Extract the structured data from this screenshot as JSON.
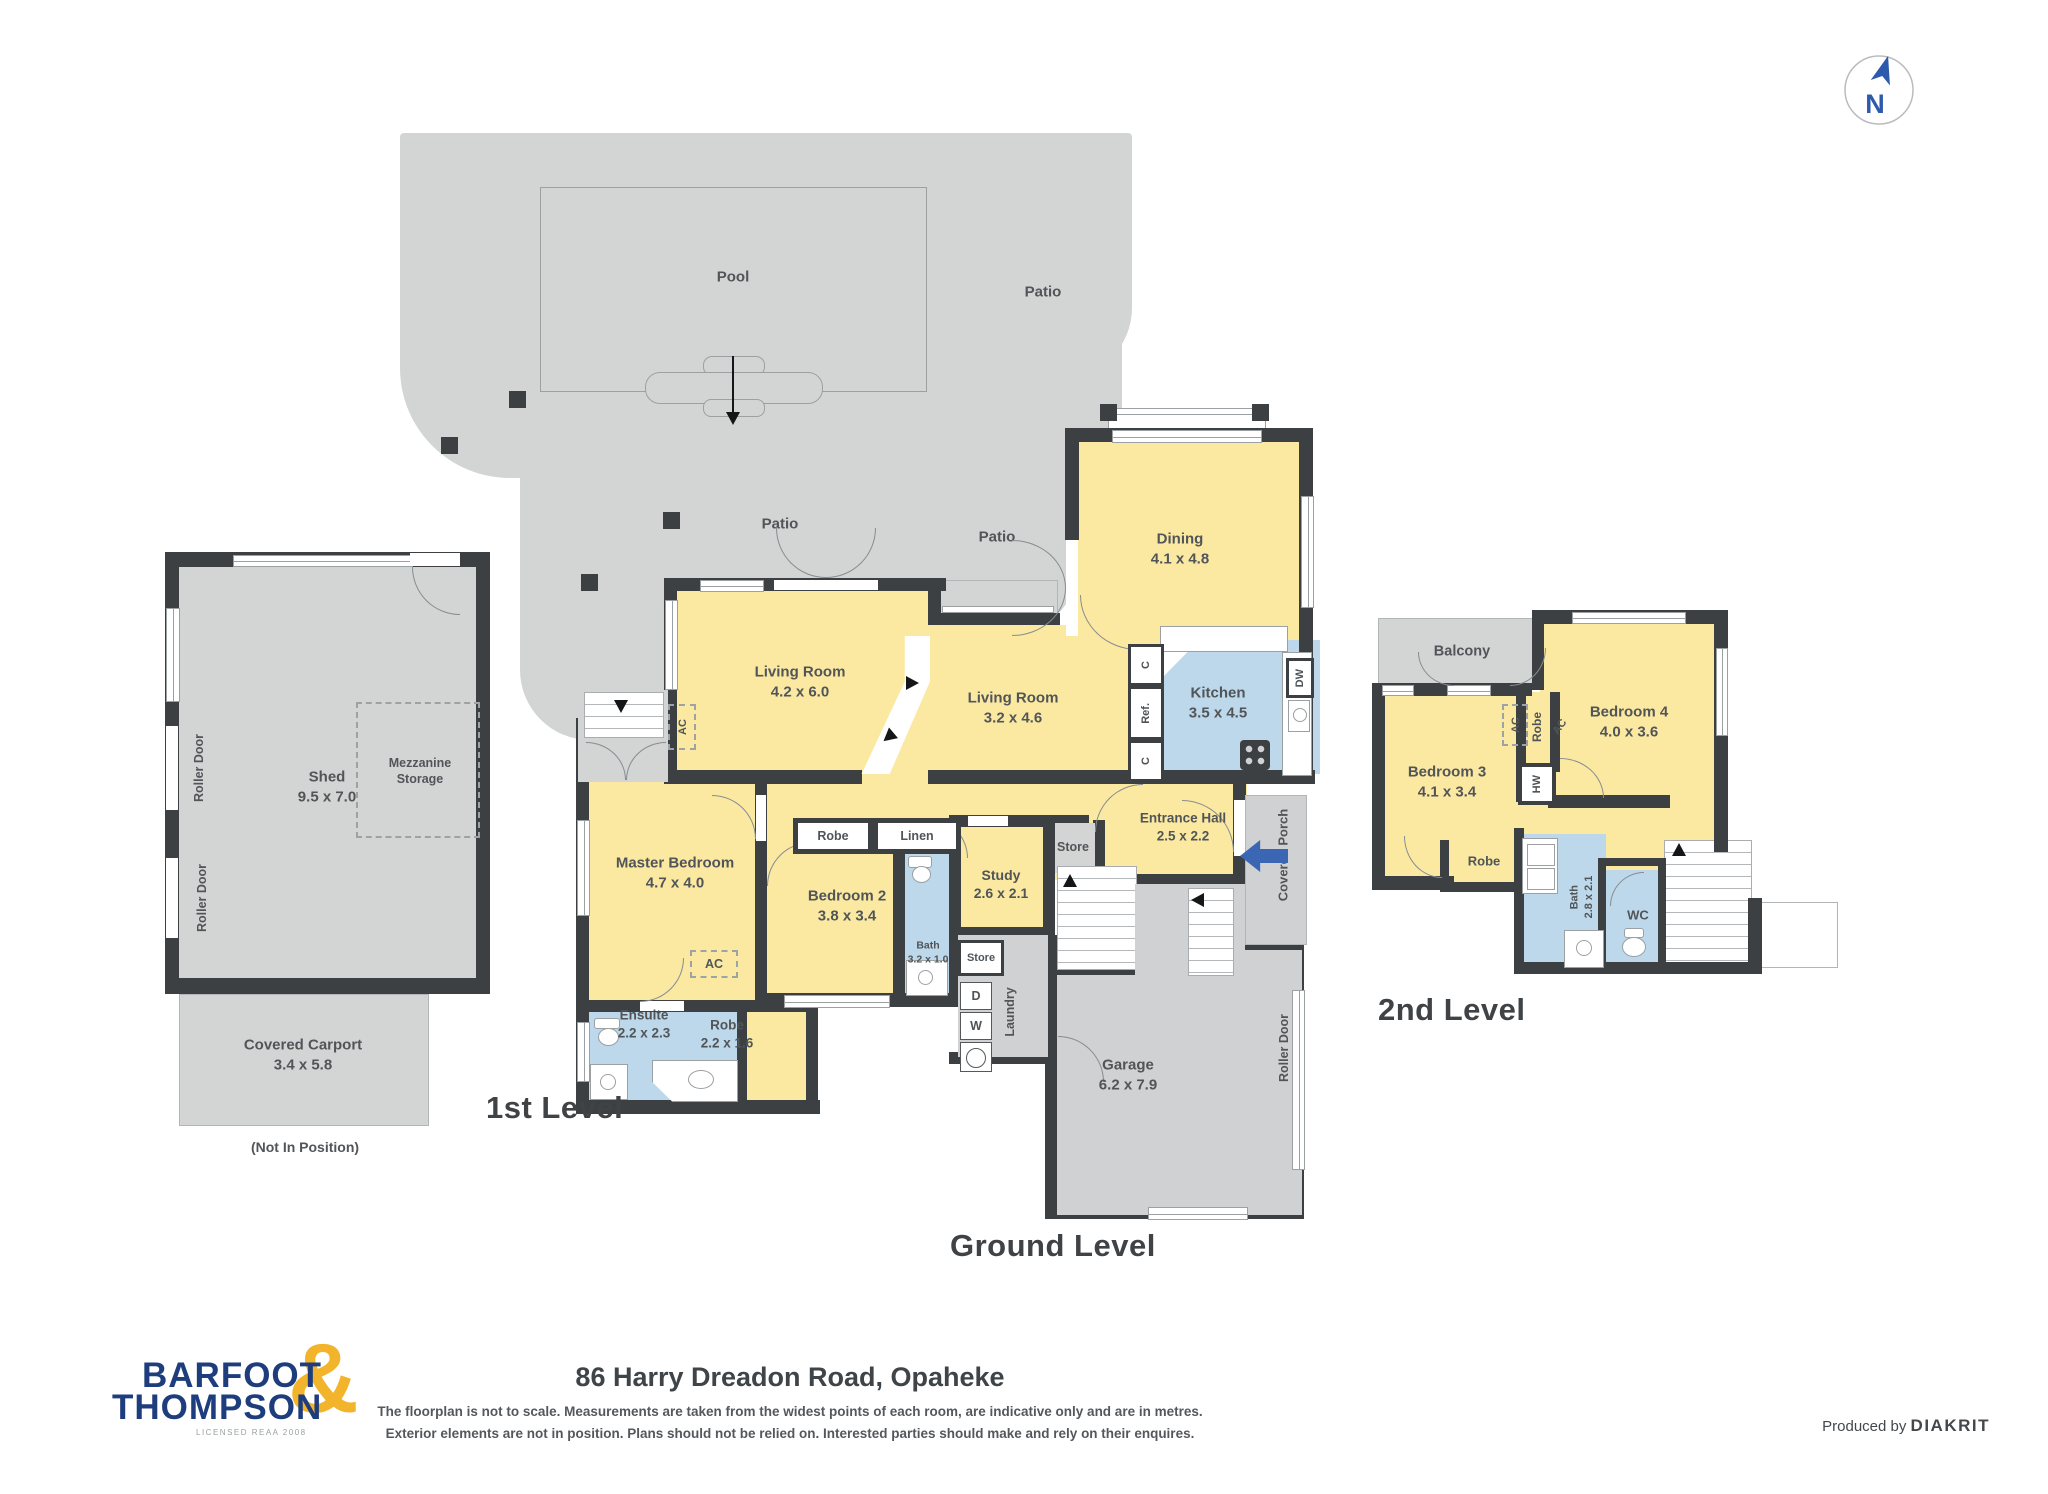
{
  "labels": {
    "pool": "Pool",
    "patio": "Patio",
    "shed_name": "Shed",
    "shed_dims": "9.5 x 7.0",
    "mezzanine": "Mezzanine Storage",
    "roller_door": "Roller Door",
    "carport_name": "Covered Carport",
    "carport_dims": "3.4 x 5.8",
    "not_in_position": "(Not In Position)",
    "balcony": "Balcony",
    "ac": "AC",
    "robe": "Robe",
    "linen": "Linen",
    "store": "Store",
    "c": "C",
    "ref": "Ref.",
    "dw": "DW",
    "d": "D",
    "w": "W",
    "hw": "HW",
    "wc": "WC",
    "laundry": "Laundry",
    "covered_porch": "Covered Porch",
    "north": "N"
  },
  "rooms": {
    "living1": {
      "name": "Living Room",
      "dims": "4.2 x 6.0"
    },
    "living2": {
      "name": "Living Room",
      "dims": "3.2 x 4.6"
    },
    "kitchen": {
      "name": "Kitchen",
      "dims": "3.5 x 4.5"
    },
    "dining": {
      "name": "Dining",
      "dims": "4.1 x 4.8"
    },
    "entrance": {
      "name": "Entrance Hall",
      "dims": "2.5 x 2.2"
    },
    "master": {
      "name": "Master Bedroom",
      "dims": "4.7 x 4.0"
    },
    "bed2": {
      "name": "Bedroom 2",
      "dims": "3.8 x 3.4"
    },
    "study": {
      "name": "Study",
      "dims": "2.6 x 2.1"
    },
    "ensuite": {
      "name": "Ensuite",
      "dims": "2.2 x 2.3"
    },
    "robe_master": {
      "name": "Robe",
      "dims": "2.2 x 1.6"
    },
    "bath1": {
      "name": "Bath",
      "dims": "3.2 x 1.0"
    },
    "garage": {
      "name": "Garage",
      "dims": "6.2 x 7.9"
    },
    "bed3": {
      "name": "Bedroom 3",
      "dims": "4.1 x 3.4"
    },
    "bed4": {
      "name": "Bedroom 4",
      "dims": "4.0 x 3.6"
    },
    "bath2": {
      "name": "Bath",
      "dims": "2.8 x 2.1"
    }
  },
  "levels": {
    "first": "1st Level",
    "ground": "Ground Level",
    "second": "2nd Level"
  },
  "footer": {
    "title": "86 Harry Dreadon Road, Opaheke",
    "disclaimer1": "The floorplan is not to scale. Measurements are taken from the widest points of each room, are indicative only and are in metres.",
    "disclaimer2": "Exterior elements are not in position. Plans should not be relied on. Interested parties should make and rely on their enquires.",
    "produced_by": "Produced by",
    "producer": "DIAKRIT",
    "logo_line1": "BARFOOT",
    "logo_line2": "THOMPSON",
    "logo_amp": "&",
    "logo_tagline": "LICENSED REAA 2008"
  },
  "colors": {
    "wall": "#3c4043",
    "room_yellow": "#fbe9a2",
    "wet_blue": "#bcd8ea",
    "exterior_gray": "#d3d5d5",
    "accent_blue": "#3a66b4",
    "logo_navy": "#1e3d7c",
    "logo_yellow": "#f2b42b"
  }
}
